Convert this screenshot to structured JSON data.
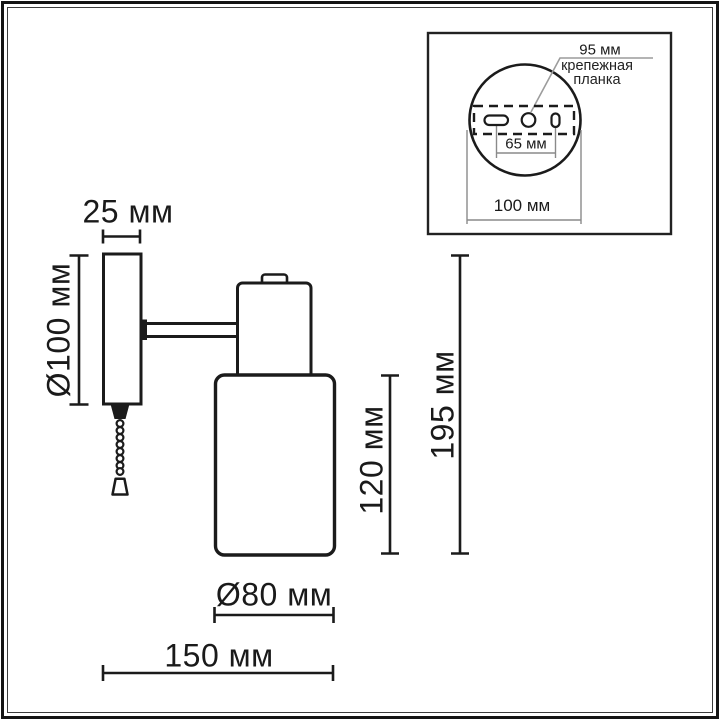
{
  "page": {
    "background": "#ffffff",
    "line_color": "#1b1b1b",
    "leader_color": "#9c9c9c"
  },
  "main_drawing": {
    "dim_plate_width": "25 мм",
    "dim_backplate_diameter": "Ø100 мм",
    "dim_shade_height": "120 мм",
    "dim_total_height": "195 мм",
    "dim_shade_diameter": "Ø80 мм",
    "dim_total_depth": "150 мм"
  },
  "inset": {
    "dim_leader_value": "95 мм",
    "callout_line1": "крепежная",
    "callout_line2": "планка",
    "dim_slot_spacing": "65 мм",
    "dim_base_width": "100 мм"
  }
}
